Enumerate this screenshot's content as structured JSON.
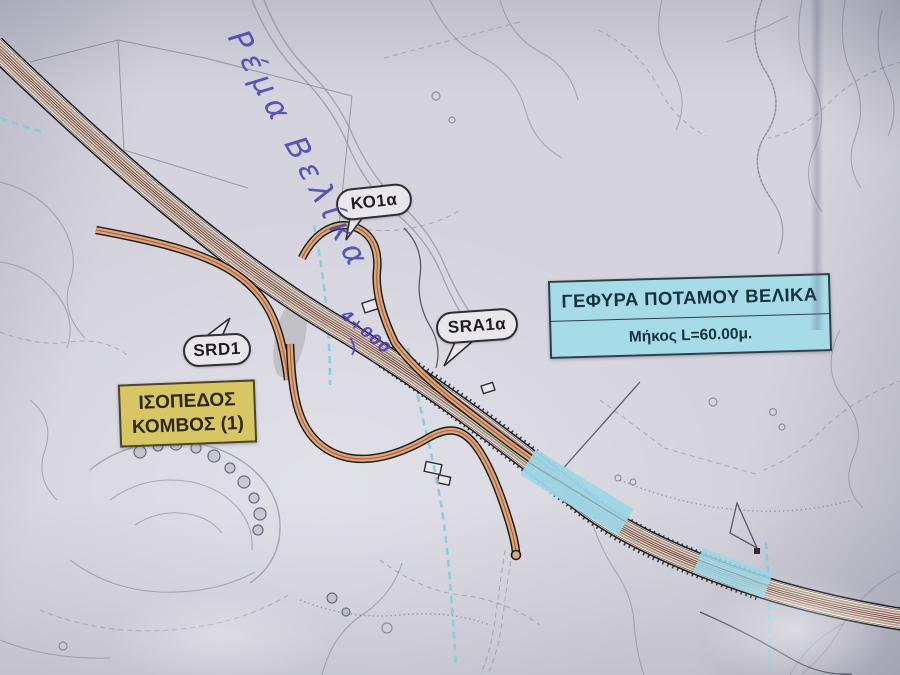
{
  "annotations": {
    "stream_name": "Ρέμα Βελίκα",
    "chainage": "4+000"
  },
  "callouts": {
    "ko1a": "ΚΟ1α",
    "srd1": "SRD1",
    "sra1a": "SRA1α"
  },
  "junction_box": {
    "line1": "ΙΣΟΠΕΔΟΣ",
    "line2": "ΚΟΜΒΟΣ (1)"
  },
  "bridge_box": {
    "title": "ΓΕΦΥΡΑ ΠΟΤΑΜΟΥ ΒΕΛΙΚΑ",
    "length": "Μήκος L=60.00μ."
  },
  "colors": {
    "paper": "#d5d4de",
    "contour": "#82828f",
    "cyan_marking": "#79cde0",
    "bridge_highlight": "#9ed7e8",
    "highway_salmon": "#c98f88",
    "highway_green": "#6f8560",
    "highway_red": "#b0524a",
    "ramp_fill": "#d9a974",
    "ink_blue": "#4743b5",
    "junction_box_fill": "#d8c665",
    "bridge_box_fill": "#a6dbe8"
  }
}
